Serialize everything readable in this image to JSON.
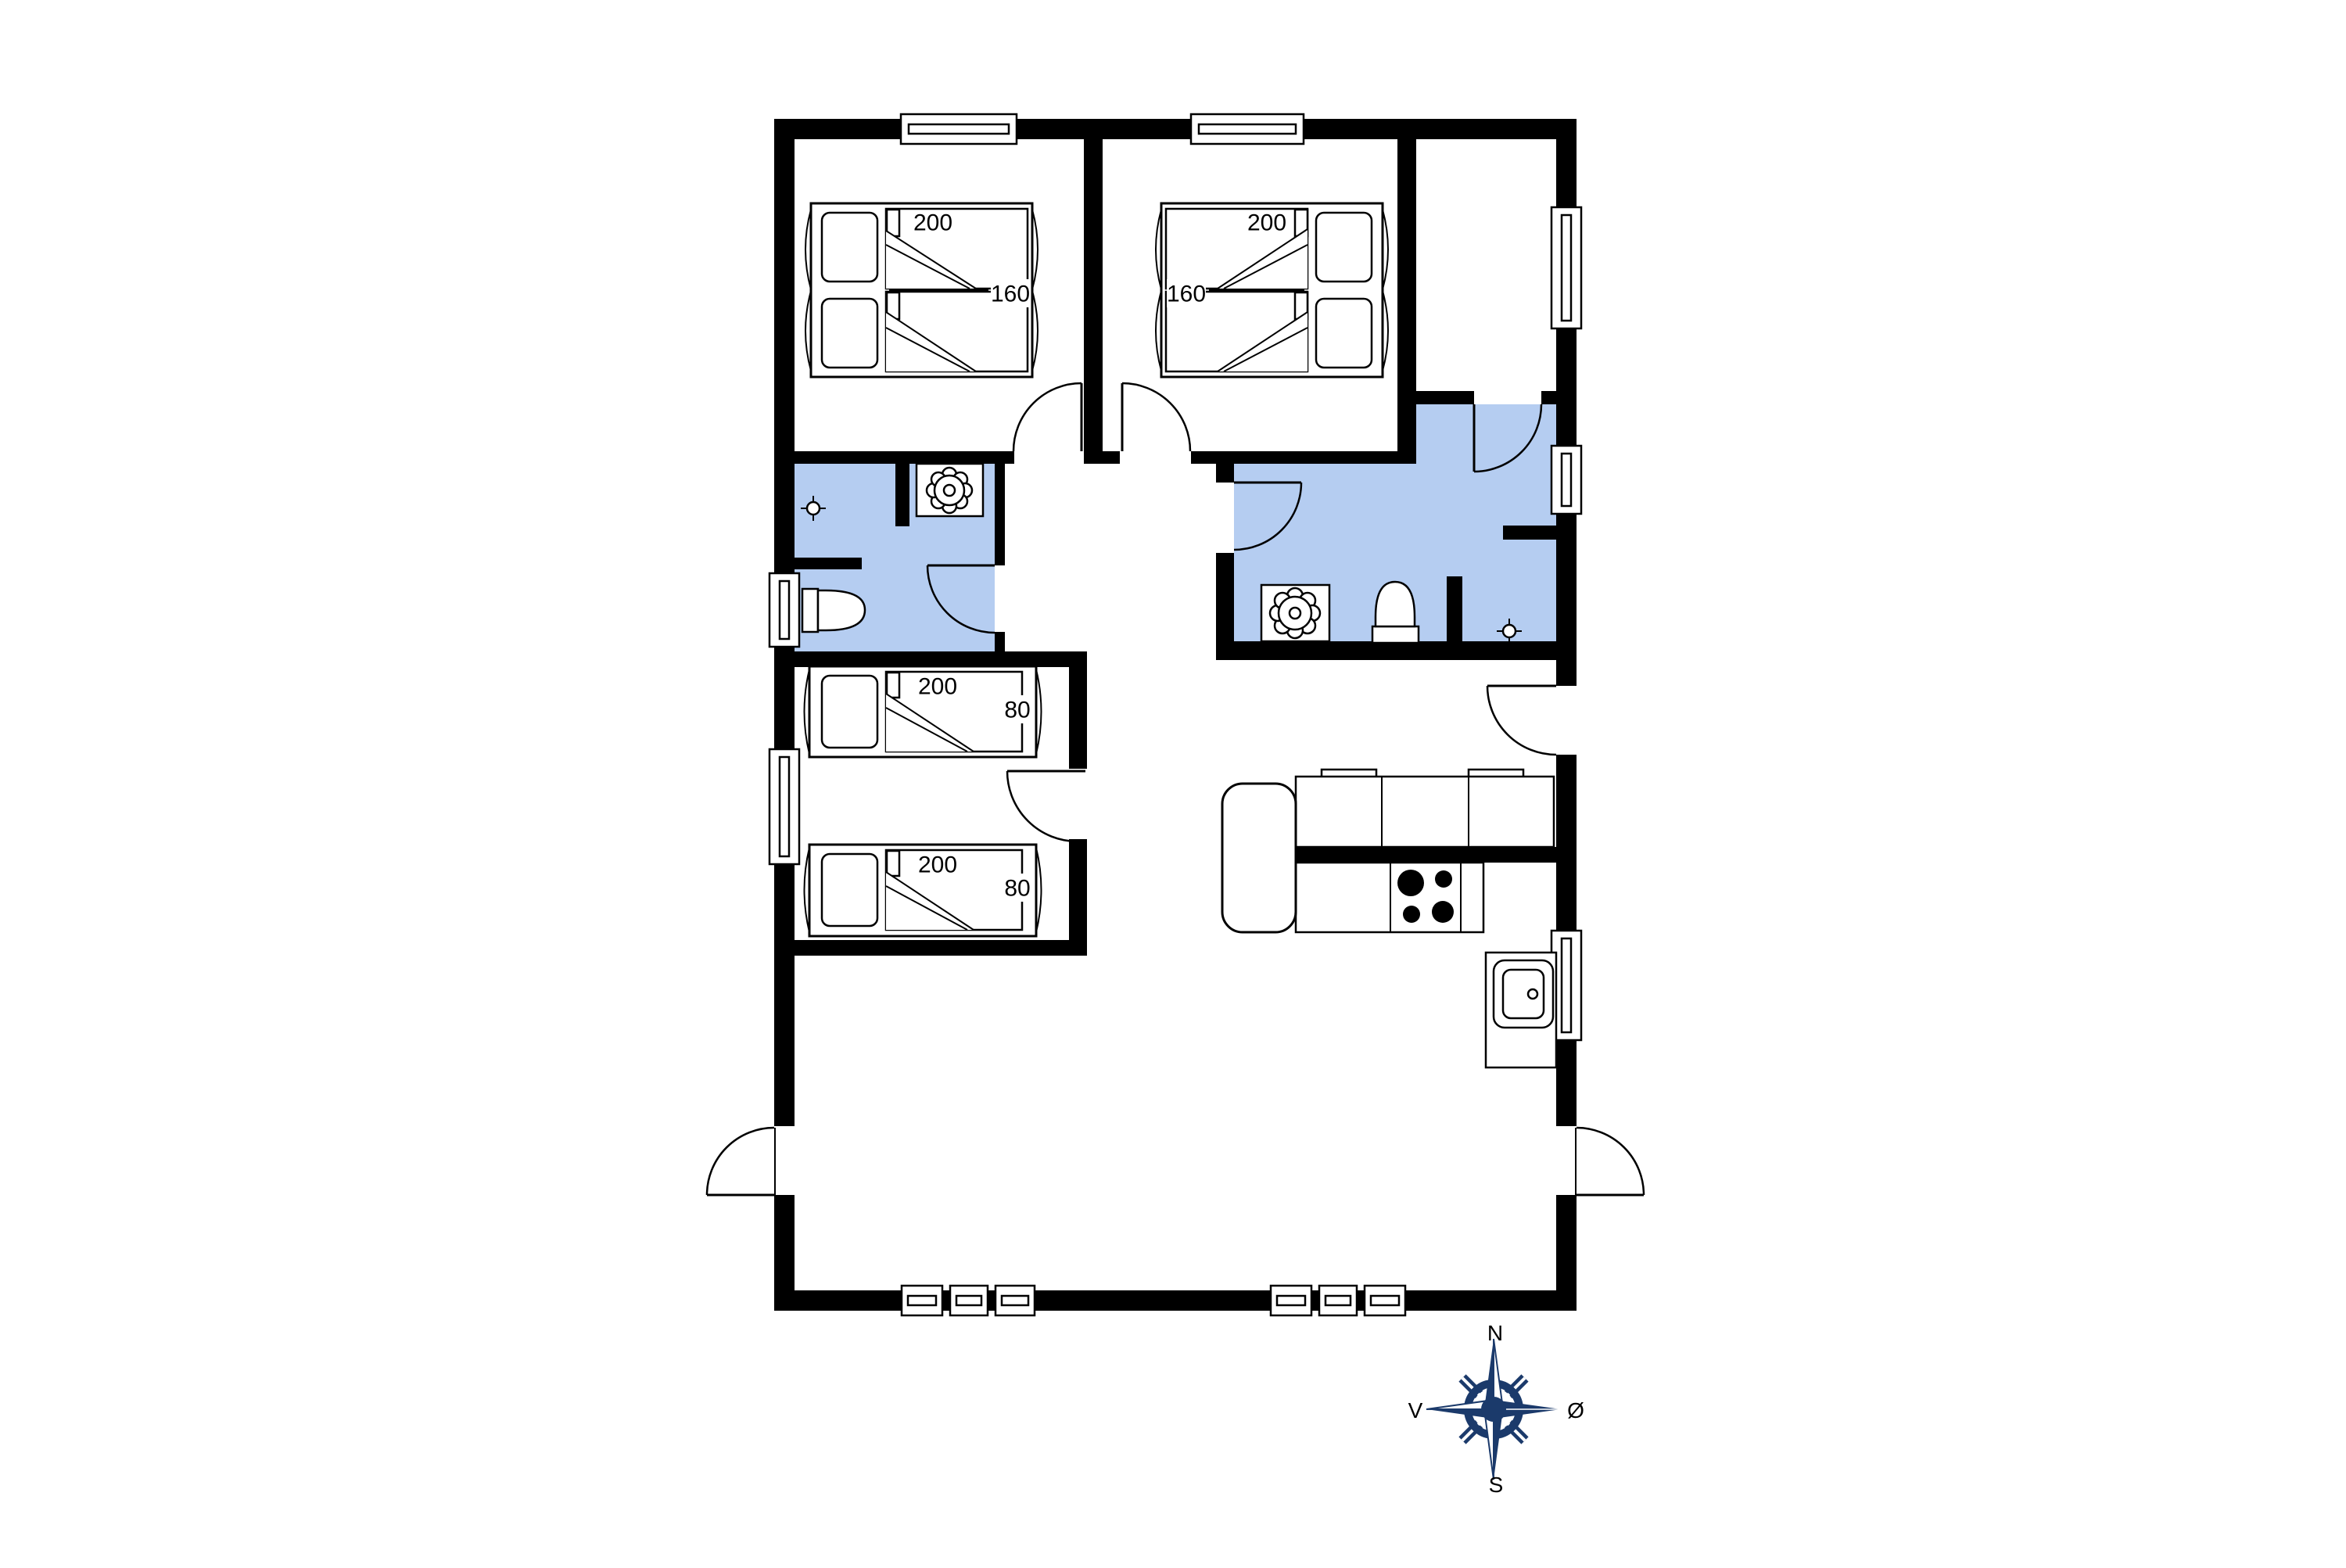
{
  "floor_plan": {
    "bedroom_1_bed": {
      "length_label": "200",
      "width_label": "160"
    },
    "bedroom_2_bed": {
      "length_label": "200",
      "width_label": "160"
    },
    "kids_bed_top": {
      "length_label": "200",
      "width_label": "80"
    },
    "kids_bed_bottom": {
      "length_label": "200",
      "width_label": "80"
    },
    "compass": {
      "north_label": "N",
      "south_label": "S",
      "west_label": "V",
      "east_label": "Ø"
    },
    "colors": {
      "wall": "#000000",
      "wet_room_fill": "#b5cdf1",
      "compass_primary": "#1b3a6b",
      "background": "#ffffff",
      "line": "#000000"
    }
  }
}
